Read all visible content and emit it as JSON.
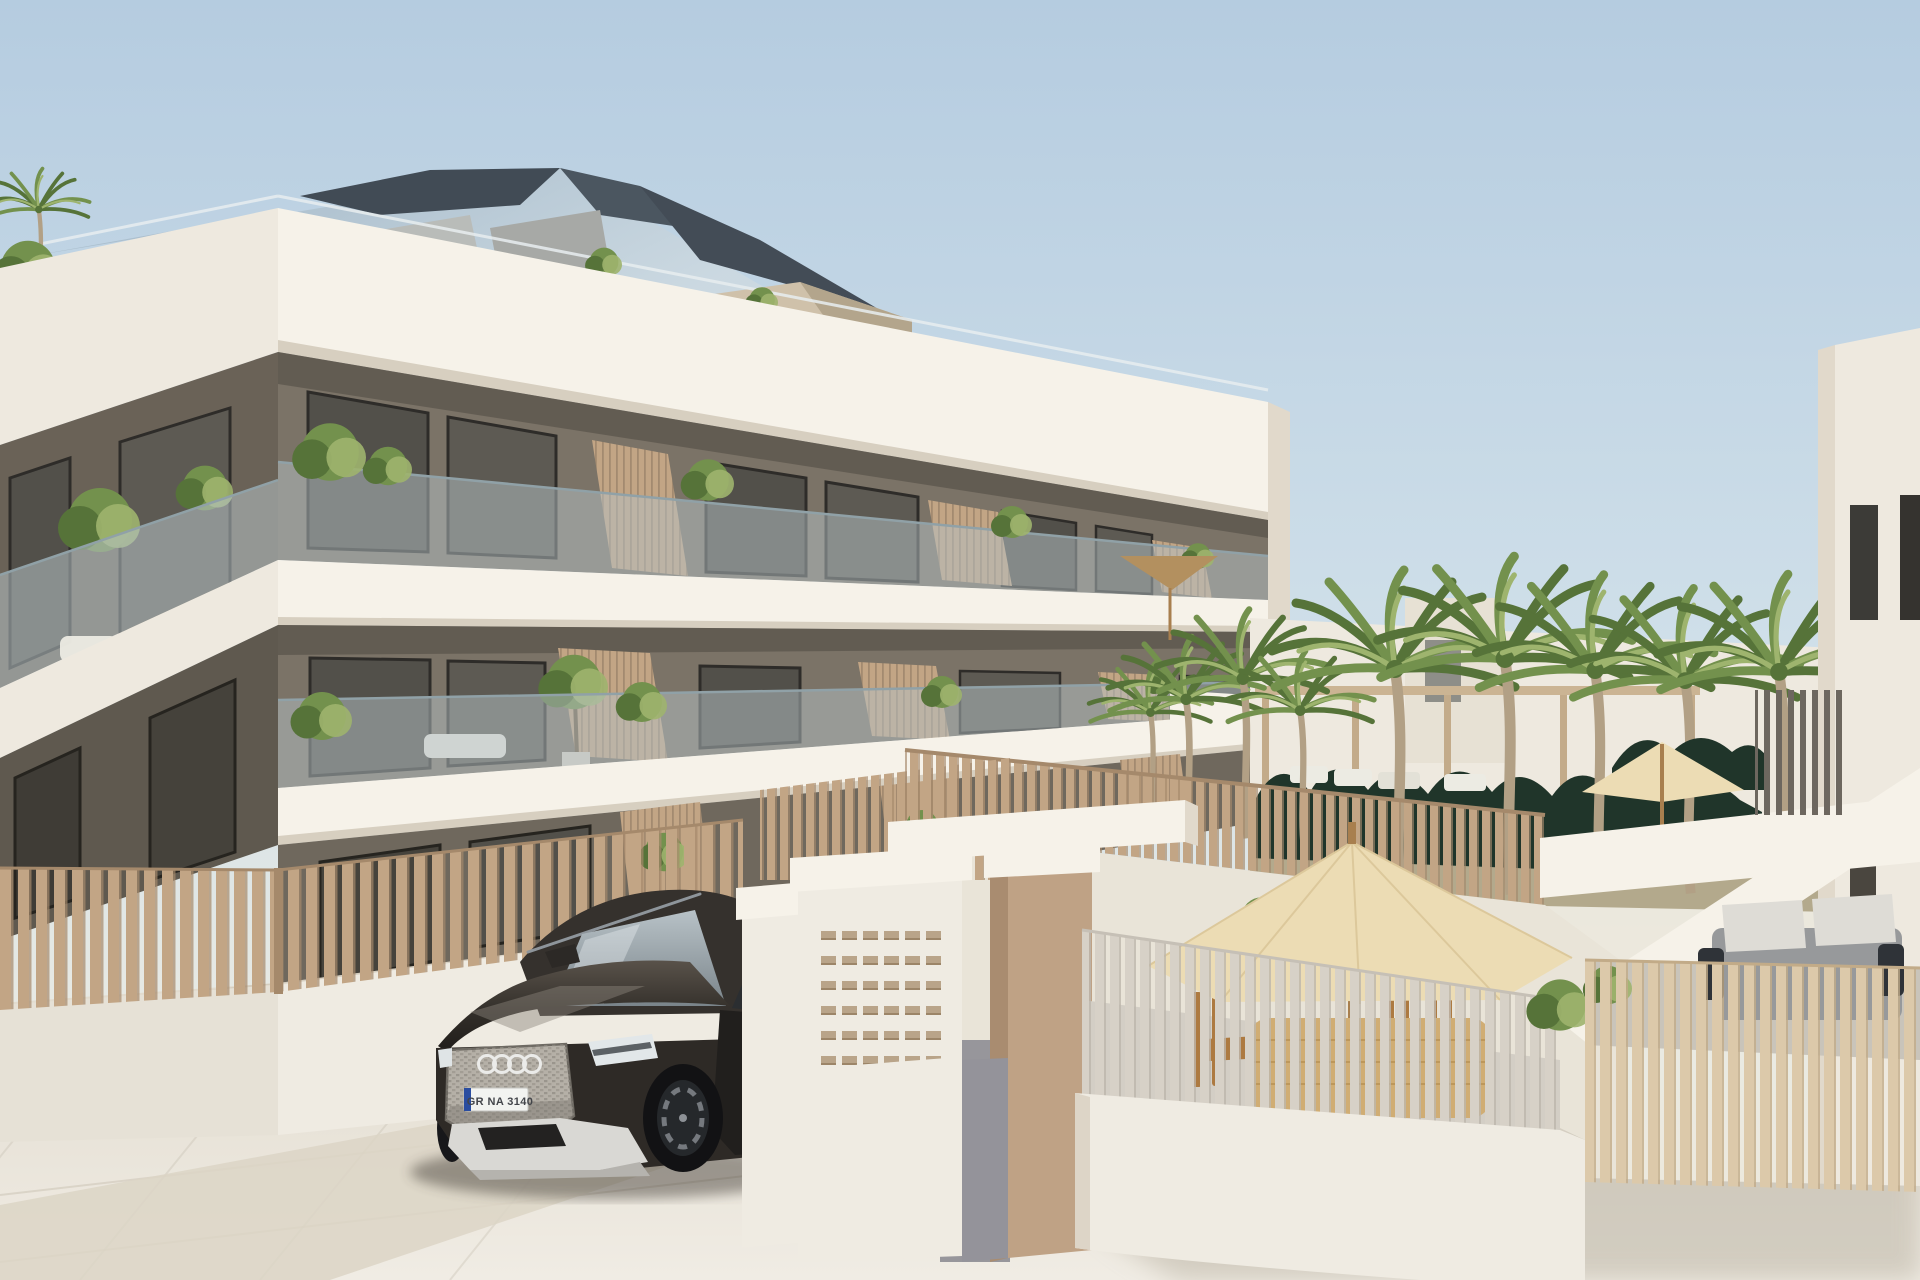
{
  "meta": {
    "type": "architectural-3d-render"
  },
  "car": {
    "brand_logo": "audi-rings",
    "license_plate": "GR NA 3140"
  },
  "palette": {
    "sky_top": "#b5cce0",
    "sky_mid": "#cfdfe9",
    "sky_horizon": "#e9eae3",
    "sky_warm": "#efe8da",
    "white_sun": "#f6f2e9",
    "white_cool": "#eee9df",
    "white_shade": "#e1d9cb",
    "soffit_shadow": "#d7cfc0",
    "wall": "#7b7367",
    "wall_shade": "#6a6257",
    "wall_dark": "#59534a",
    "wall_ground": "#6f685d",
    "window_frame": "#2e2c29",
    "window_glass": "#52504a",
    "glass_rail": "#b6c2c6",
    "glass_edge": "#90a1a7",
    "wood": "#c2a585",
    "wood_light": "#d5bf9f",
    "wood_dark": "#a5896b",
    "slat_gray": "#d7d1c7",
    "slat_pale": "#dcc9aa",
    "roof_slate": "#414b55",
    "roof_glass": "#a9bdcc",
    "penthouse_beige": "#cfc1aa",
    "hedge_green": "#20352a",
    "grass_dry": "#b3a98c",
    "palm_green": "#73914d",
    "palm_dark": "#567339",
    "palm_light": "#9eb46e",
    "palm_trunk": "#b2a085",
    "umbrella_cream": "#ecdcb4",
    "umbrella_cream_shade": "#dcc89b",
    "umbrella_tan": "#b3905f",
    "pole_wood": "#a87f4e",
    "pave_light": "#f0ece4",
    "pave_mid": "#ded7c9",
    "pave_shadow": "#bfb8a9",
    "walkway_gray": "#94939a",
    "plinth_white": "#efebe2",
    "tan_wall": "#bfa285",
    "tan_wall_shade": "#a98c70",
    "mailbox_slot": "#b9a489",
    "car_body": "#2e2a26",
    "car_body_light": "#665f55",
    "car_glass": "#a3adb2",
    "car_silver": "#d9d8d4",
    "car_dark": "#17171a",
    "car_rim": "#75797e",
    "plate_white": "#f2f3f0",
    "plate_blue": "#2a4da0",
    "plate_text_color": "#43454a",
    "sofa_gray": "#97999b",
    "cushion_light": "#dedcd6",
    "table_rattan": "#d0ad74",
    "chair_wood": "#ad7a41",
    "lounger_white": "#ecebe3"
  }
}
